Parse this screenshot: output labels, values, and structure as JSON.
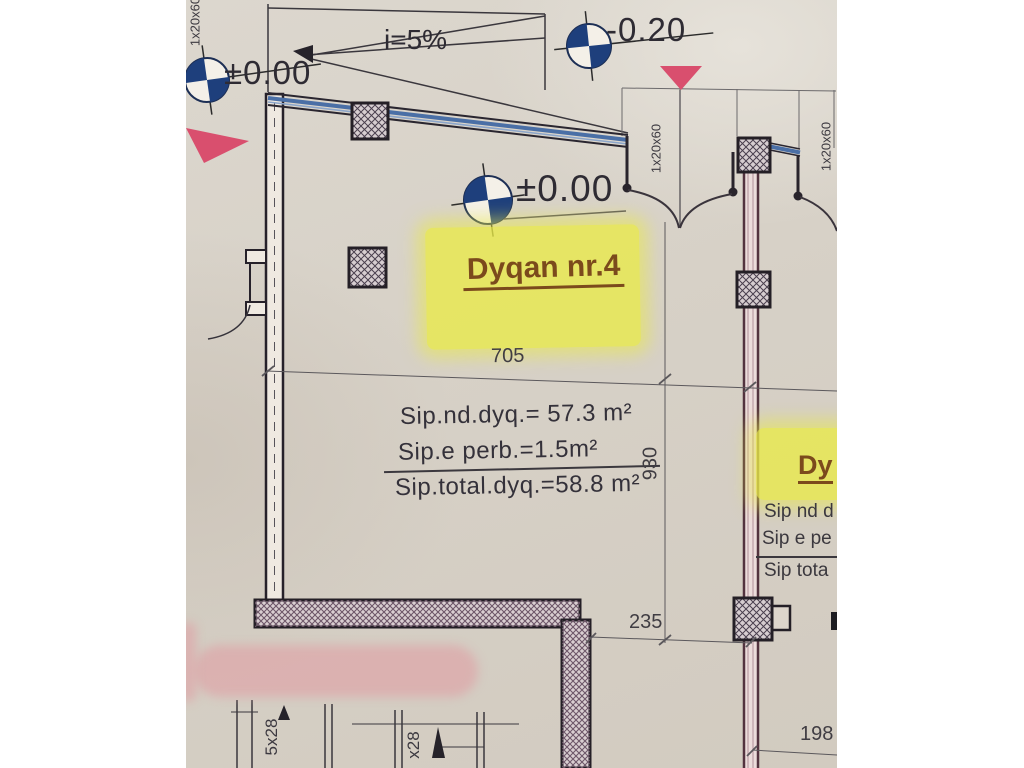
{
  "drawing_type": "architectural floor plan (photo)",
  "levels": {
    "top_left": "±0.00",
    "top_right": "-0.20",
    "room": "±0.00"
  },
  "slope": {
    "label": "i=5%"
  },
  "room": {
    "name": "Dyqan nr.4"
  },
  "areas": {
    "net": "Sip.nd.dyq.= 57.3 m²",
    "common": "Sip.e perb.=1.5m²",
    "total": "Sip.total.dyq.=58.8 m²"
  },
  "dims": {
    "width": "705",
    "height": "930",
    "recess": "235",
    "right_bottom": "198",
    "door": "1x20x60",
    "stair_a": "5x28",
    "stair_b": "x28"
  },
  "neighbor": {
    "title": "Dy",
    "line1": "Sip nd d",
    "line2": "Sip e pe",
    "line3": "Sip tota"
  },
  "colors": {
    "paper": "#d7d1c7",
    "ink": "#29242c",
    "glazing_blue": "#4a6fa6",
    "benchmark_navy": "#1e3f7c",
    "marker_pink": "#d94f6e",
    "wall_maroon": "#53333f",
    "highlight_yellow": "#e9ea48",
    "label_brown": "#7b4a1c"
  }
}
